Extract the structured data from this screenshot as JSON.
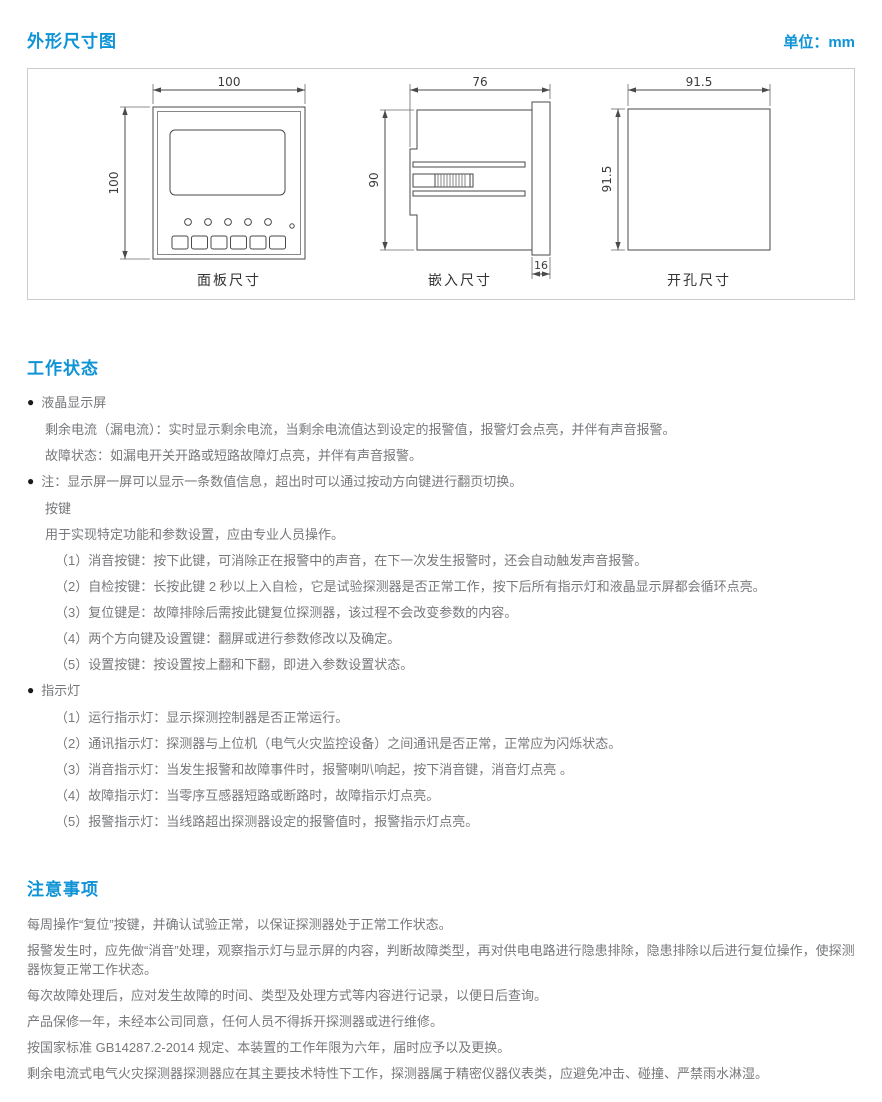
{
  "colors": {
    "accent": "#0d93d6",
    "body_text": "#77787b",
    "diagram_line": "#4a4a4a",
    "box_border": "#cbcbcb"
  },
  "header": {
    "title": "外形尺寸图",
    "unit": "单位：mm"
  },
  "dimension_box": {
    "panel": {
      "caption": "面板尺寸",
      "width_label": "100",
      "height_label": "100"
    },
    "side": {
      "caption": "嵌入尺寸",
      "width_label": "76",
      "height_label": "90",
      "depth_label": "16"
    },
    "cutout": {
      "caption": "开孔尺寸",
      "width_label": "91.5",
      "height_label": "91.5"
    }
  },
  "working_status": {
    "heading": "工作状态",
    "bullet_glyph": "●",
    "lcd": {
      "title": "液晶显示屏",
      "lines": [
        "剩余电流（漏电流）：实时显示剩余电流，当剩余电流值达到设定的报警值，报警灯会点亮，并伴有声音报警。",
        "故障状态：如漏电开关开路或短路故障灯点亮，并伴有声音报警。"
      ]
    },
    "note": {
      "title": "注：显示屏一屏可以显示一条数值信息，超出时可以通过按动方向键进行翻页切换。",
      "subtitle": "按键",
      "intro": "用于实现特定功能和参数设置，应由专业人员操作。",
      "items": [
        "（1）消音按键：按下此键，可消除正在报警中的声音，在下一次发生报警时，还会自动触发声音报警。",
        "（2）自检按键：长按此键 2 秒以上入自检，它是试验探测器是否正常工作，按下后所有指示灯和液晶显示屏都会循环点亮。",
        "（3）复位键是：故障排除后需按此键复位探测器，该过程不会改变参数的内容。",
        "（4）两个方向键及设置键：翻屏或进行参数修改以及确定。",
        "（5）设置按键：按设置按上翻和下翻，即进入参数设置状态。"
      ]
    },
    "indicators": {
      "title": "指示灯",
      "items": [
        "（1）运行指示灯：显示探测控制器是否正常运行。",
        "（2）通讯指示灯：探测器与上位机（电气火灾监控设备）之间通讯是否正常，正常应为闪烁状态。",
        "（3）消音指示灯：当发生报警和故障事件时，报警喇叭响起，按下消音键，消音灯点亮 。",
        "（4）故障指示灯：当零序互感器短路或断路时，故障指示灯点亮。",
        "（5）报警指示灯：当线路超出探测器设定的报警值时，报警指示灯点亮。"
      ]
    }
  },
  "precautions": {
    "heading": "注意事项",
    "paragraphs": [
      "每周操作“复位”按键，并确认试验正常，以保证探测器处于正常工作状态。",
      "报警发生时，应先做“消音”处理，观察指示灯与显示屏的内容，判断故障类型，再对供电电路进行隐患排除，隐患排除以后进行复位操作，使探测器恢复正常工作状态。",
      "每次故障处理后，应对发生故障的时间、类型及处理方式等内容进行记录，以便日后查询。",
      "产品保修一年，未经本公司同意，任何人员不得拆开探测器或进行维修。",
      "按国家标准 GB14287.2-2014 规定、本装置的工作年限为六年，届时应予以及更换。",
      "剩余电流式电气火灾探测器探测器应在其主要技术特性下工作，探测器属于精密仪器仪表类，应避免冲击、碰撞、严禁雨水淋湿。"
    ]
  }
}
